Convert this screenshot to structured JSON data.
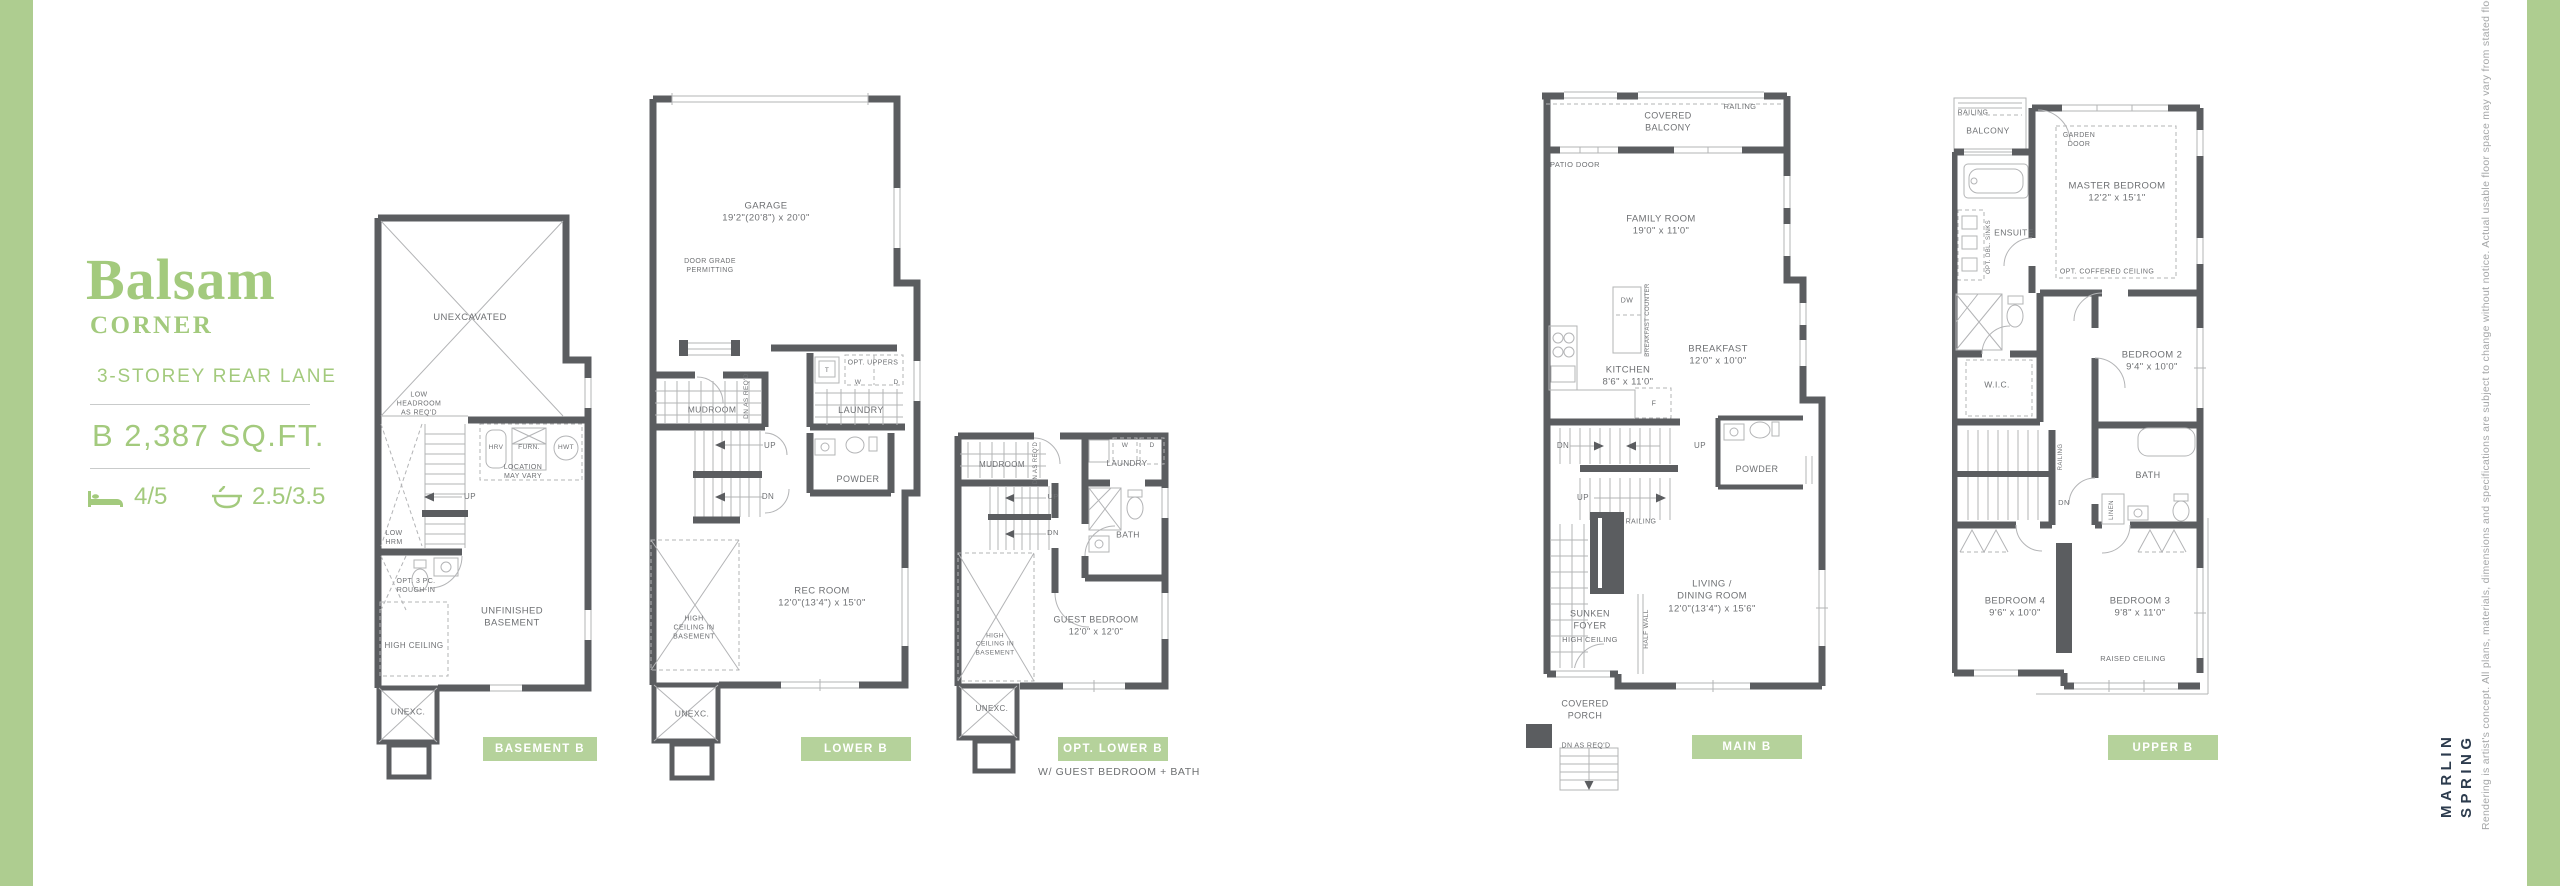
{
  "colors": {
    "accent_green": "#aecd90",
    "chip_green": "#b5d29b",
    "title_green": "#a3ca7d",
    "wall_gray": "#5b5d60"
  },
  "title_block": {
    "name": "Balsam",
    "collection": "CORNER",
    "storey": "3-STOREY REAR LANE",
    "area": "B 2,387 SQ.FT.",
    "beds": "4/5",
    "baths": "2.5/3.5"
  },
  "plans": {
    "basement": {
      "chip": "BASEMENT B",
      "labels": {
        "unexcavated": "UNEXCAVATED",
        "low_headroom": "LOW\nHEADROOM\nAS REQ'D",
        "hrv": "HRV",
        "furn": "FURN.",
        "hwt": "HWT",
        "location_may_vary": "LOCATION\nMAY VARY",
        "up": "UP",
        "low_hrm": "LOW\nHRM",
        "opt_rough_in": "OPT. 3 PC.\nROUGH-IN",
        "high_ceiling": "HIGH CEILING",
        "unfinished_basement": "UNFINISHED\nBASEMENT",
        "unexc": "UNEXC."
      }
    },
    "lower": {
      "chip": "LOWER B",
      "labels": {
        "garage": "GARAGE\n19'2\"(20'8\") x 20'0\"",
        "door_grade": "DOOR GRADE\nPERMITTING",
        "opt_uppers": "OPT. UPPERS",
        "t": "T",
        "w": "W",
        "d": "D",
        "mudroom": "MUDROOM",
        "dn_as_reqd": "DN AS\nREQ'D",
        "laundry": "LAUNDRY",
        "up": "UP",
        "dn": "DN",
        "powder": "POWDER",
        "high_ceiling_basement": "HIGH\nCEILING IN\nBASEMENT",
        "rec_room": "REC ROOM\n12'0\"(13'4\") x 15'0\"",
        "unexc": "UNEXC."
      }
    },
    "opt_lower": {
      "chip": "OPT. LOWER B",
      "caption": "W/ GUEST BEDROOM + BATH",
      "labels": {
        "mudroom": "MUDROOM",
        "dn_as_reqd": "DN AS\nREQ'D",
        "laundry": "LAUNDRY",
        "w": "W",
        "d": "D",
        "up": "UP",
        "dn": "DN",
        "bath": "BATH",
        "guest_bedroom": "GUEST BEDROOM\n12'0\" x 12'0\"",
        "high_ceiling_basement": "HIGH\nCEILING IN\nBASEMENT",
        "unexc": "UNEXC."
      }
    },
    "main": {
      "chip": "MAIN B",
      "labels": {
        "railing": "RAILING",
        "covered_balcony": "COVERED\nBALCONY",
        "patio_door": "PATIO DOOR",
        "family_room": "FAMILY ROOM\n19'0\" x 11'0\"",
        "dw": "DW",
        "breakfast_counter": "BREAKFAST COUNTER",
        "kitchen": "KITCHEN\n8'6\" x 11'0\"",
        "breakfast": "BREAKFAST\n12'0\" x 10'0\"",
        "fridge": "F",
        "dn": "DN",
        "up": "UP",
        "up2": "UP",
        "powder": "POWDER",
        "railing2": "RAILING",
        "sunken_foyer": "SUNKEN\nFOYER",
        "high_ceiling": "HIGH CEILING",
        "half_wall": "HALF WALL",
        "living_dining": "LIVING /\nDINING ROOM\n12'0\"(13'4\") x 15'6\"",
        "covered_porch": "COVERED\nPORCH",
        "dn_as_reqd": "DN AS REQ'D"
      }
    },
    "upper": {
      "chip": "UPPER B",
      "labels": {
        "railing": "RAILING",
        "balcony": "BALCONY",
        "garden_door": "GARDEN\nDOOR",
        "master_bedroom": "MASTER BEDROOM\n12'2\" x 15'1\"",
        "opt_coffered_ceiling": "OPT. COFFERED CEILING",
        "ensuite": "ENSUITE",
        "opt_dbl_sinks": "OPT. DBL. SINKS",
        "wic": "W.I.C.",
        "bedroom2": "BEDROOM 2\n9'4\" x 10'0\"",
        "railing2": "RAILING",
        "dn": "DN",
        "bath": "BATH",
        "linen": "LINEN",
        "bedroom4": "BEDROOM 4\n9'6\" x 10'0\"",
        "bedroom3": "BEDROOM 3\n9'8\" x 11'0\"",
        "raised_ceiling": "RAISED CEILING"
      }
    }
  },
  "sidebar": {
    "brand": "MARLIN\nSPRING",
    "disclaimer": "Rendering is artist's concept. All plans, materials, dimensions and specifications are subject to change without notice. Actual usable floor space may vary from stated floor area. E.&O.E. - BL 2010 (CORNER)"
  }
}
